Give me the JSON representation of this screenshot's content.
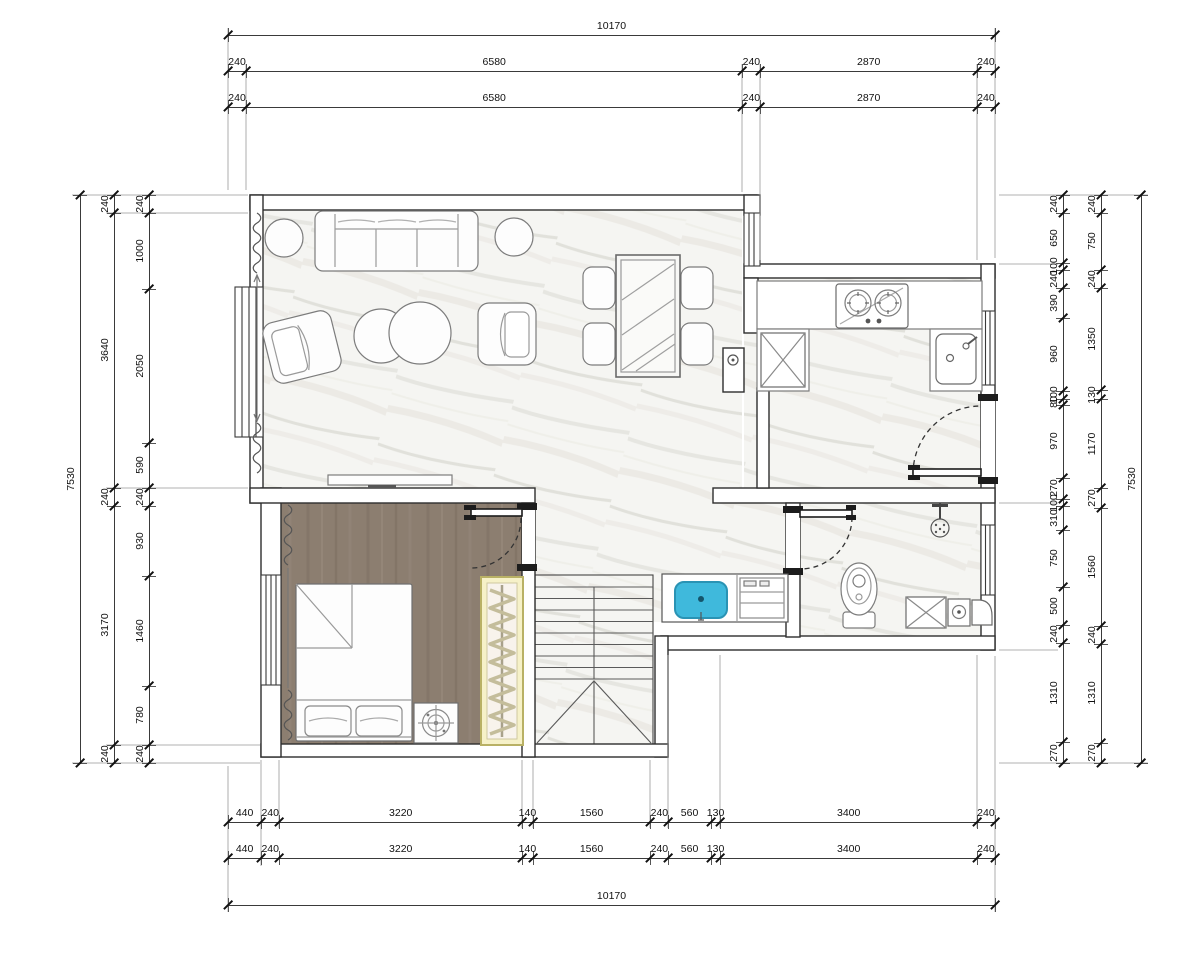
{
  "page": {
    "type": "architectural floor plan, upper level of duplex apartment"
  },
  "colors": {
    "basin": "#3fb9dc",
    "basin_stroke": "#2a93b4",
    "wood_floor": "#8c7e70",
    "wardrobe": "#f6f1c8",
    "marble": "#f5f5f2",
    "wall_stroke": "#2e2e2e",
    "dim_text": "#111111"
  },
  "dimensions": {
    "top_total": "10170",
    "top_row2": [
      "240",
      "6580",
      "240",
      "2870",
      "240"
    ],
    "top_row3": [
      "240",
      "6580",
      "240",
      "2870",
      "240"
    ],
    "bottom_row1": [
      "440",
      "240",
      "3220",
      "140",
      "1560",
      "240",
      "560",
      "130",
      "3400",
      "240"
    ],
    "bottom_row2": [
      "440",
      "240",
      "3220",
      "140",
      "1560",
      "240",
      "560",
      "130",
      "3400",
      "240"
    ],
    "bottom_total": "10170",
    "left_total": "7530",
    "left_mid": [
      "240",
      "3640",
      "240",
      "3170",
      "240"
    ],
    "left_inner": [
      "240",
      "1000",
      "2050",
      "590",
      "240",
      "930",
      "1460",
      "780",
      "240"
    ],
    "right_inner": [
      "240",
      "650",
      "100",
      "240",
      "390",
      "960",
      "100",
      "80",
      "970",
      "270",
      "100",
      "310",
      "750",
      "500",
      "240",
      "1310",
      "270"
    ],
    "right_mid": [
      "240",
      "750",
      "240",
      "1350",
      "130",
      "1170",
      "270",
      "1560",
      "240",
      "1310",
      "270"
    ],
    "right_total": "7530"
  }
}
